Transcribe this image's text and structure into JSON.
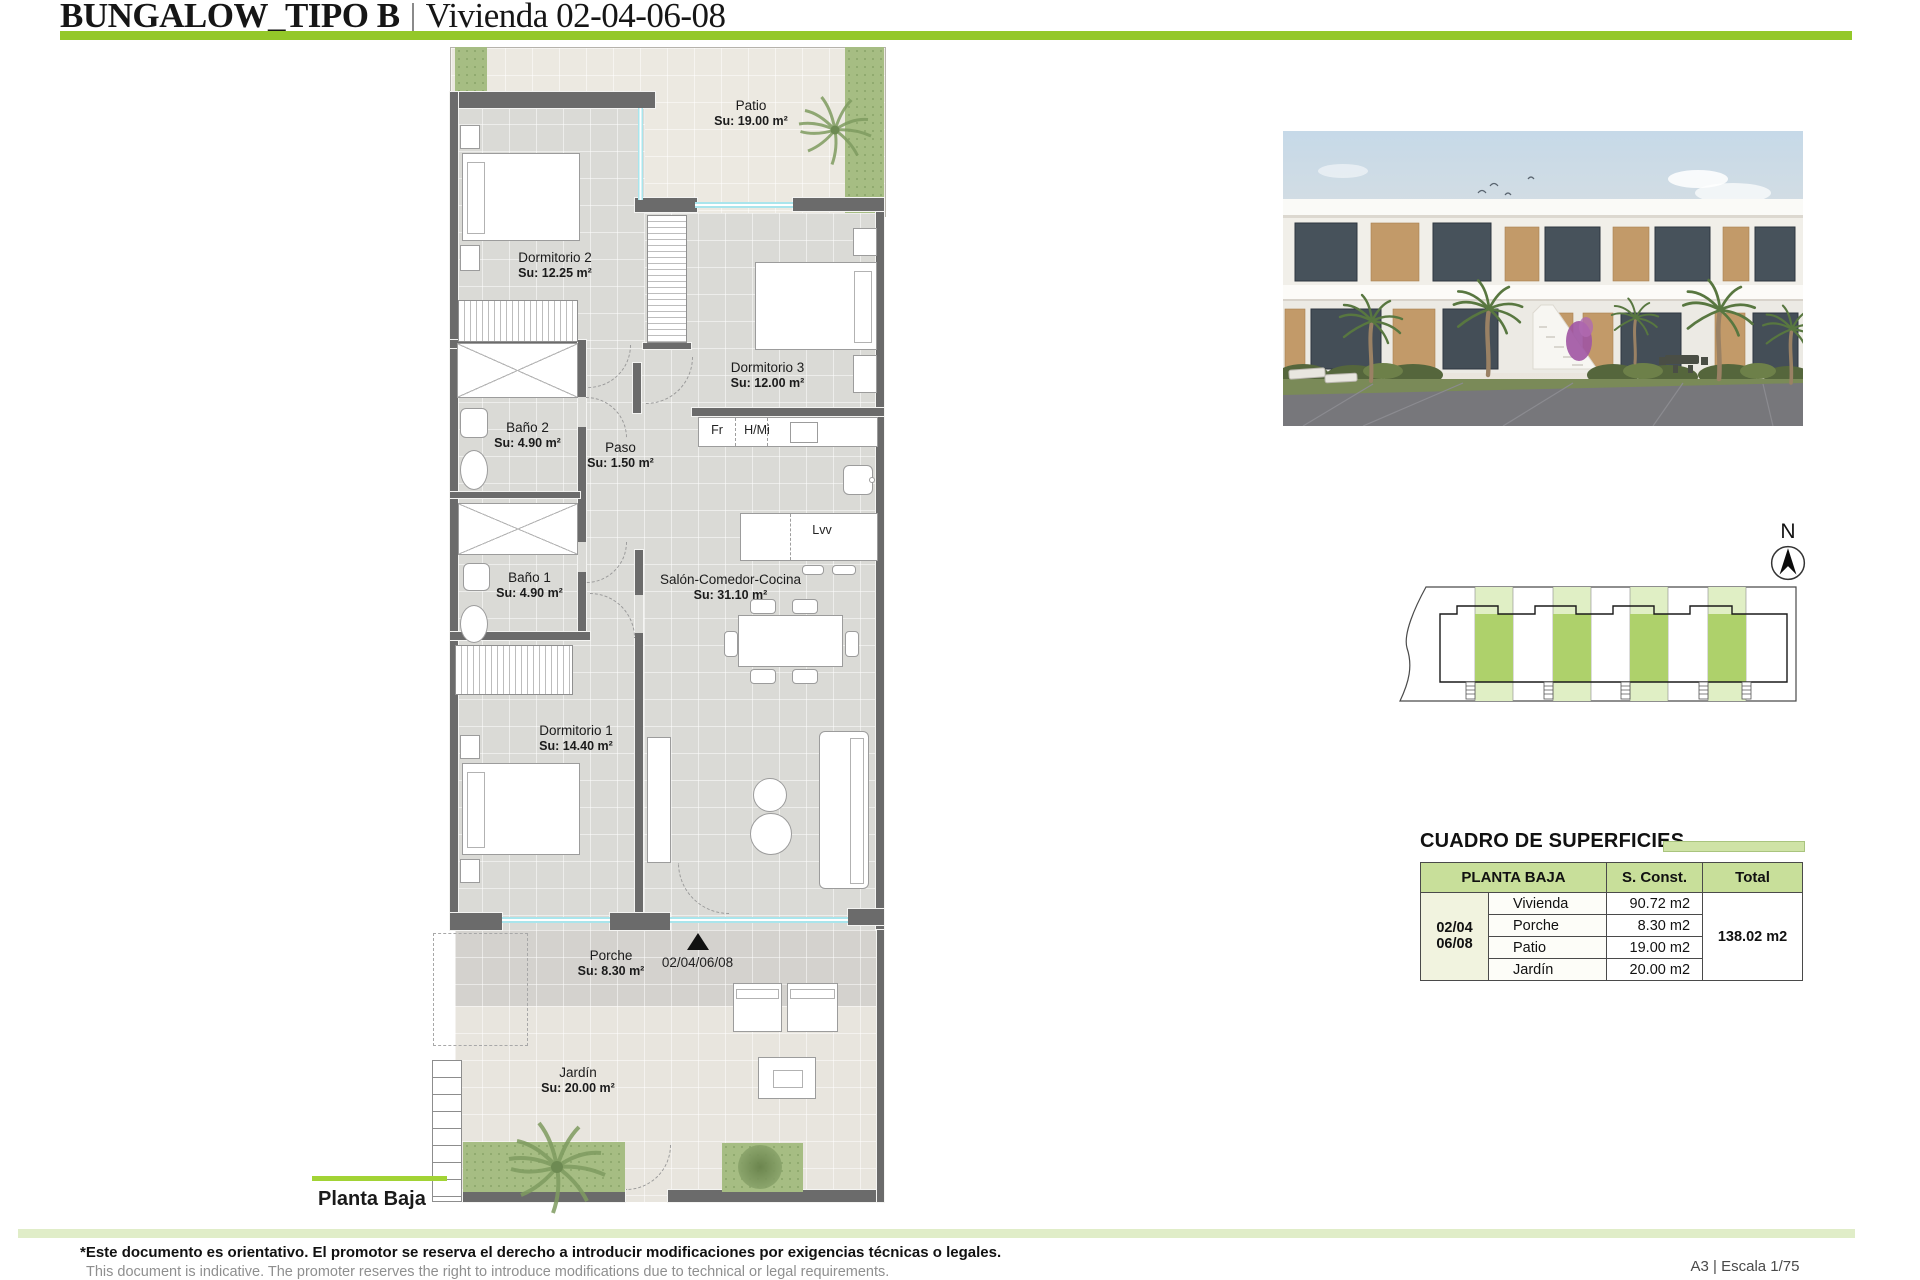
{
  "header": {
    "project": "BUNGALOW_TIPO B",
    "unit": "Vivienda 02-04-06-08"
  },
  "plan": {
    "caption": "Planta Baja",
    "entrance_units": "02/04/06/08",
    "north_label": "N",
    "rooms": [
      {
        "name": "Patio",
        "area": "Su: 19.00 m²"
      },
      {
        "name": "Dormitorio 2",
        "area": "Su: 12.25 m²"
      },
      {
        "name": "Dormitorio 3",
        "area": "Su: 12.00 m²"
      },
      {
        "name": "Baño 2",
        "area": "Su: 4.90 m²"
      },
      {
        "name": "Paso",
        "area": "Su: 1.50 m²"
      },
      {
        "name": "Baño 1",
        "area": "Su: 4.90 m²"
      },
      {
        "name": "Salón-Comedor-Cocina",
        "area": "Su: 31.10 m²"
      },
      {
        "name": "Dormitorio 1",
        "area": "Su: 14.40 m²"
      },
      {
        "name": "Porche",
        "area": "Su: 8.30 m²"
      },
      {
        "name": "Jardín",
        "area": "Su: 20.00 m²"
      }
    ],
    "appliances": {
      "fridge": "Fr",
      "oven_micro": "H/Mi",
      "dishwasher": "Lvv"
    }
  },
  "surfaces_table": {
    "title": "CUADRO DE SUPERFICIES",
    "headers": {
      "floor": "PLANTA BAJA",
      "s_const": "S. Const.",
      "total": "Total"
    },
    "unit_group_line1": "02/04",
    "unit_group_line2": "06/08",
    "rows": [
      {
        "name": "Vivienda",
        "value": "90.72 m2"
      },
      {
        "name": "Porche",
        "value": "8.30 m2"
      },
      {
        "name": "Patio",
        "value": "19.00 m2"
      },
      {
        "name": "Jardín",
        "value": "20.00 m2"
      }
    ],
    "total_value": "138.02 m2"
  },
  "footer": {
    "disclaimer_es": "*Este documento es orientativo. El promotor se reserva el derecho a introducir modificaciones por exigencias técnicas o legales.",
    "disclaimer_en": "This document is indicative. The promoter reserves the right to introduce modifications due to technical or legal requirements.",
    "sheet": "A3 | Escala 1/75"
  },
  "colors": {
    "accent_green": "#94c829",
    "table_header_green": "#c8df9a",
    "pale_green_strip": "#e0edc8",
    "wall_gray": "#6b6b6b",
    "window_cyan": "#a9e5ec"
  }
}
